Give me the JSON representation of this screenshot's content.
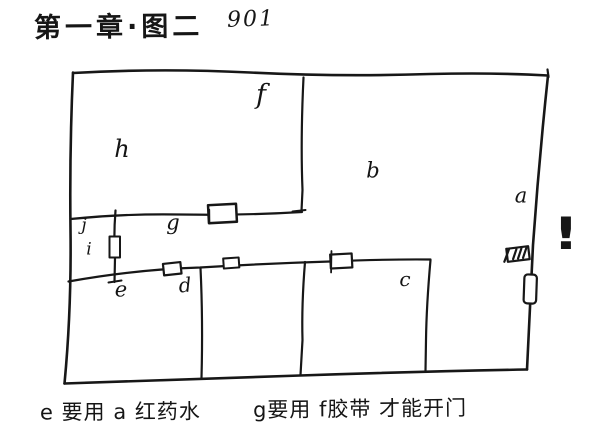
{
  "page": {
    "background": "#ffffff",
    "ink": "#171717",
    "kind": "hand-drawn floor plan sketch"
  },
  "header": {
    "title": "第一章·图二",
    "code": "901"
  },
  "floorplan": {
    "labels": {
      "a": "a",
      "b": "b",
      "c": "c",
      "d": "d",
      "e": "e",
      "f": "f",
      "g": "g",
      "h": "h",
      "i": "i",
      "j": "j"
    },
    "exclamation": "!",
    "markers": [
      "door-marker-g",
      "door-marker-i",
      "door-marker-d",
      "door-marker-small",
      "door-marker-c",
      "hatched-vent",
      "door-marker-right-wall"
    ]
  },
  "notes": {
    "left": "e 要用 a 红药水",
    "right": "g要用 f胶带 才能开门"
  }
}
